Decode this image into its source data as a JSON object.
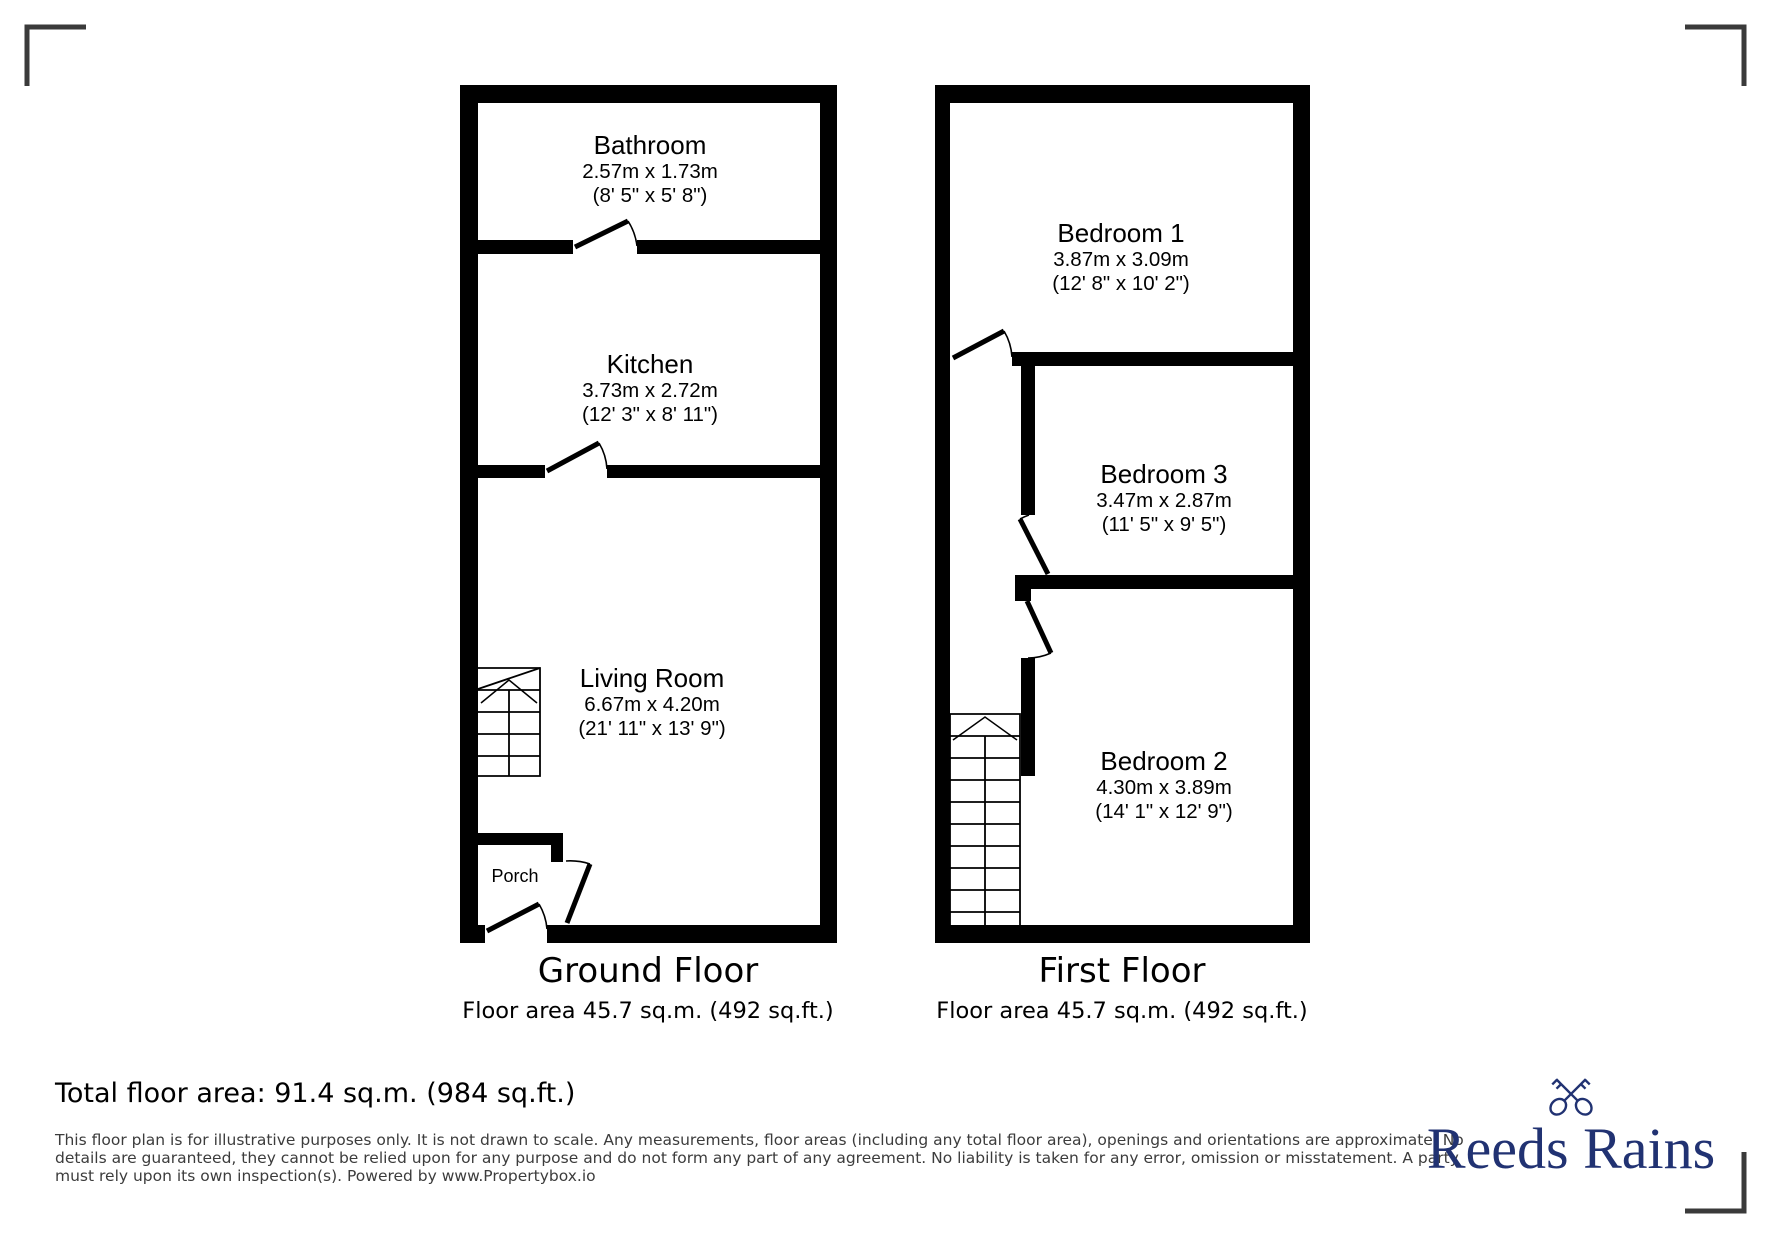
{
  "ground_floor": {
    "title": "Ground Floor",
    "area": "Floor area 45.7 sq.m. (492 sq.ft.)",
    "rooms": {
      "bathroom": {
        "name": "Bathroom",
        "metric": "2.57m x 1.73m",
        "imperial": "(8' 5\" x 5' 8\")"
      },
      "kitchen": {
        "name": "Kitchen",
        "metric": "3.73m x 2.72m",
        "imperial": "(12' 3\" x 8' 11\")"
      },
      "living_room": {
        "name": "Living Room",
        "metric": "6.67m x 4.20m",
        "imperial": "(21' 11\" x 13' 9\")"
      },
      "porch": {
        "name": "Porch"
      }
    }
  },
  "first_floor": {
    "title": "First Floor",
    "area": "Floor area 45.7 sq.m. (492 sq.ft.)",
    "rooms": {
      "bedroom1": {
        "name": "Bedroom 1",
        "metric": "3.87m x 3.09m",
        "imperial": "(12' 8\" x 10' 2\")"
      },
      "bedroom3": {
        "name": "Bedroom 3",
        "metric": "3.47m x 2.87m",
        "imperial": "(11' 5\" x 9' 5\")"
      },
      "bedroom2": {
        "name": "Bedroom 2",
        "metric": "4.30m x 3.89m",
        "imperial": "(14' 1\" x 12' 9\")"
      }
    }
  },
  "summary": {
    "total_area": "Total floor area: 91.4 sq.m. (984 sq.ft.)"
  },
  "disclaimer": {
    "lines": [
      "This floor plan is for illustrative purposes only. It is not drawn to scale. Any measurements, floor areas (including any total floor area), openings and orientations are approximate. No",
      "details are guaranteed, they cannot be relied upon for any purpose and do not form any part of any agreement. No liability is taken for any error, omission or misstatement. A party",
      "must rely upon its own inspection(s). Powered by www.Propertybox.io"
    ]
  },
  "brand": {
    "name": "Reeds Rains",
    "icon": "crossed-keys",
    "color": "#213272"
  },
  "colors": {
    "walls": "#000000",
    "corner_marks": "#3a3a3a",
    "disclaimer_text": "#3c3c3c"
  }
}
